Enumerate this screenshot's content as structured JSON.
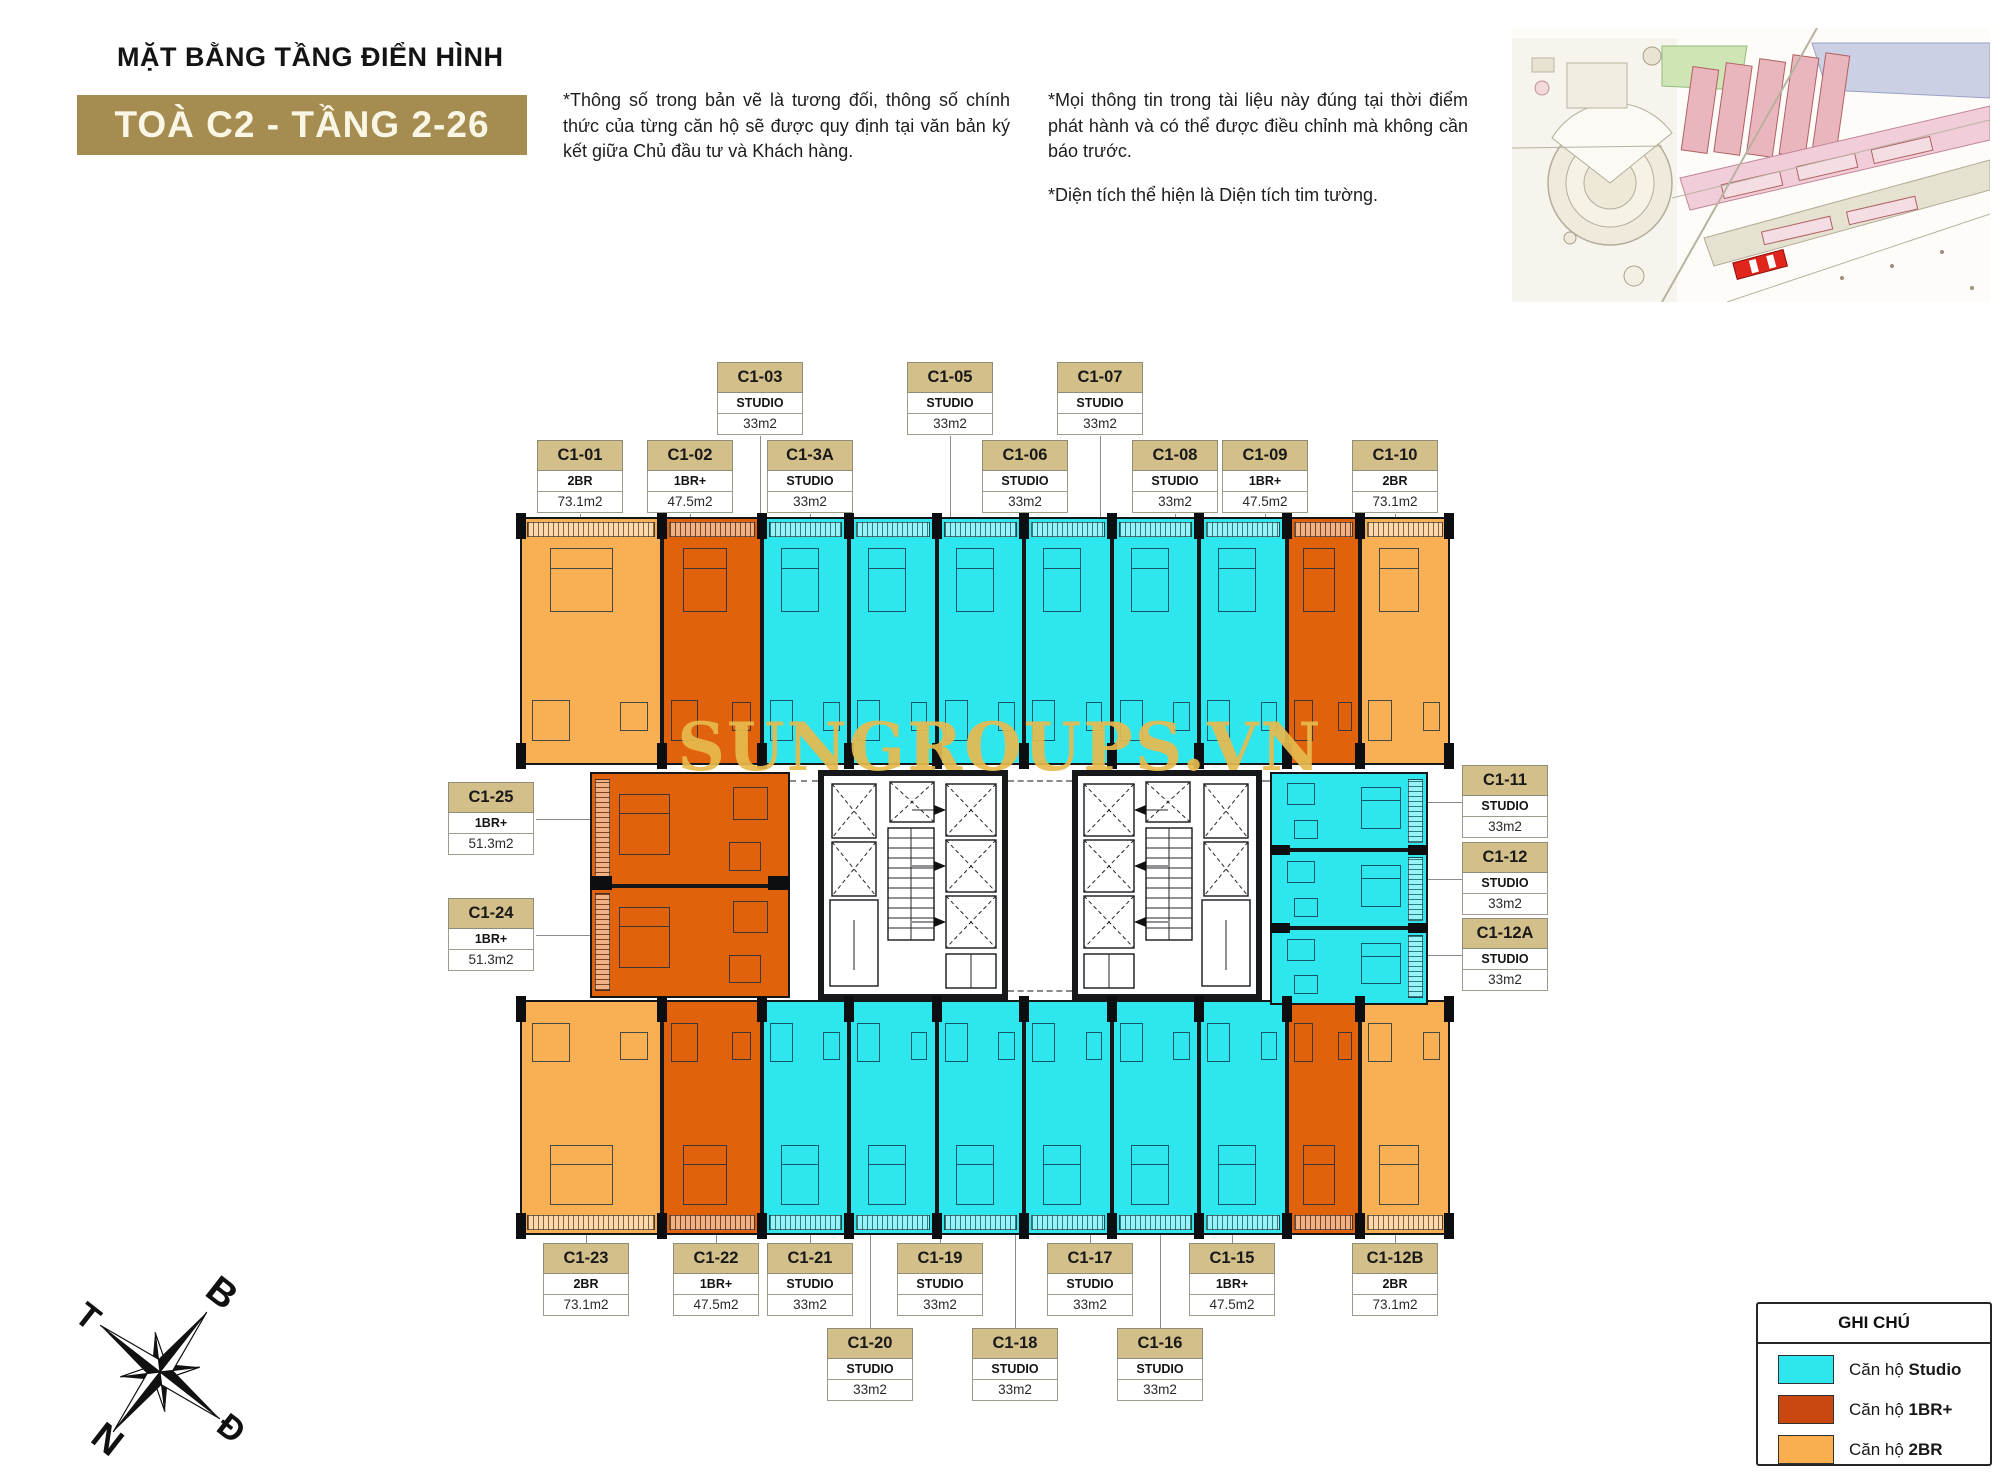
{
  "header": {
    "title": "MẶT BẰNG TẦNG ĐIỂN HÌNH",
    "badge": "TOÀ C2 - TẦNG 2-26",
    "disclaimer1": "*Thông số trong bản vẽ là tương đối, thông số chính thức của từng căn hộ sẽ được quy định tại văn bản ký kết giữa Chủ đầu tư và Khách hàng.",
    "disclaimer2": "*Mọi thông tin trong tài liệu này đúng tại thời điểm phát hành và có thể được điều chỉnh mà không cần báo trước.",
    "disclaimer3": "*Diện tích thể hiện là Diện tích tim tường."
  },
  "watermark": "SUNGROUPS.VN",
  "compass": {
    "north": "B",
    "east": "Đ",
    "south": "N",
    "west": "T"
  },
  "legend": {
    "title": "GHI CHÚ",
    "items": [
      {
        "label_prefix": "Căn hộ ",
        "label_bold": "Studio",
        "color": "#2ee7ee"
      },
      {
        "label_prefix": "Căn hộ ",
        "label_bold": "1BR+",
        "color": "#c8480f"
      },
      {
        "label_prefix": "Căn hộ ",
        "label_bold": "2BR",
        "color": "#fbae4d"
      }
    ]
  },
  "colors": {
    "studio": "#2ee7ee",
    "one_br": "#e0620d",
    "two_br": "#f9b055",
    "badge_bg": "#a58c50",
    "card_header_bg": "#d3bf8a",
    "watermark_gold": "#e7ba4e"
  },
  "units": [
    {
      "id": "C1-01",
      "type": "2BR",
      "area": "73.1m2",
      "cat": "two_br"
    },
    {
      "id": "C1-02",
      "type": "1BR+",
      "area": "47.5m2",
      "cat": "one_br"
    },
    {
      "id": "C1-03",
      "type": "STUDIO",
      "area": "33m2",
      "cat": "studio"
    },
    {
      "id": "C1-3A",
      "type": "STUDIO",
      "area": "33m2",
      "cat": "studio"
    },
    {
      "id": "C1-05",
      "type": "STUDIO",
      "area": "33m2",
      "cat": "studio"
    },
    {
      "id": "C1-06",
      "type": "STUDIO",
      "area": "33m2",
      "cat": "studio"
    },
    {
      "id": "C1-07",
      "type": "STUDIO",
      "area": "33m2",
      "cat": "studio"
    },
    {
      "id": "C1-08",
      "type": "STUDIO",
      "area": "33m2",
      "cat": "studio"
    },
    {
      "id": "C1-09",
      "type": "1BR+",
      "area": "47.5m2",
      "cat": "one_br"
    },
    {
      "id": "C1-10",
      "type": "2BR",
      "area": "73.1m2",
      "cat": "two_br"
    },
    {
      "id": "C1-11",
      "type": "STUDIO",
      "area": "33m2",
      "cat": "studio"
    },
    {
      "id": "C1-12",
      "type": "STUDIO",
      "area": "33m2",
      "cat": "studio"
    },
    {
      "id": "C1-12A",
      "type": "STUDIO",
      "area": "33m2",
      "cat": "studio"
    },
    {
      "id": "C1-12B",
      "type": "2BR",
      "area": "73.1m2",
      "cat": "two_br"
    },
    {
      "id": "C1-15",
      "type": "1BR+",
      "area": "47.5m2",
      "cat": "one_br"
    },
    {
      "id": "C1-16",
      "type": "STUDIO",
      "area": "33m2",
      "cat": "studio"
    },
    {
      "id": "C1-17",
      "type": "STUDIO",
      "area": "33m2",
      "cat": "studio"
    },
    {
      "id": "C1-18",
      "type": "STUDIO",
      "area": "33m2",
      "cat": "studio"
    },
    {
      "id": "C1-19",
      "type": "STUDIO",
      "area": "33m2",
      "cat": "studio"
    },
    {
      "id": "C1-20",
      "type": "STUDIO",
      "area": "33m2",
      "cat": "studio"
    },
    {
      "id": "C1-21",
      "type": "STUDIO",
      "area": "33m2",
      "cat": "studio"
    },
    {
      "id": "C1-22",
      "type": "1BR+",
      "area": "47.5m2",
      "cat": "one_br"
    },
    {
      "id": "C1-23",
      "type": "2BR",
      "area": "73.1m2",
      "cat": "two_br"
    },
    {
      "id": "C1-24",
      "type": "1BR+",
      "area": "51.3m2",
      "cat": "one_br"
    },
    {
      "id": "C1-25",
      "type": "1BR+",
      "area": "51.3m2",
      "cat": "one_br"
    }
  ]
}
